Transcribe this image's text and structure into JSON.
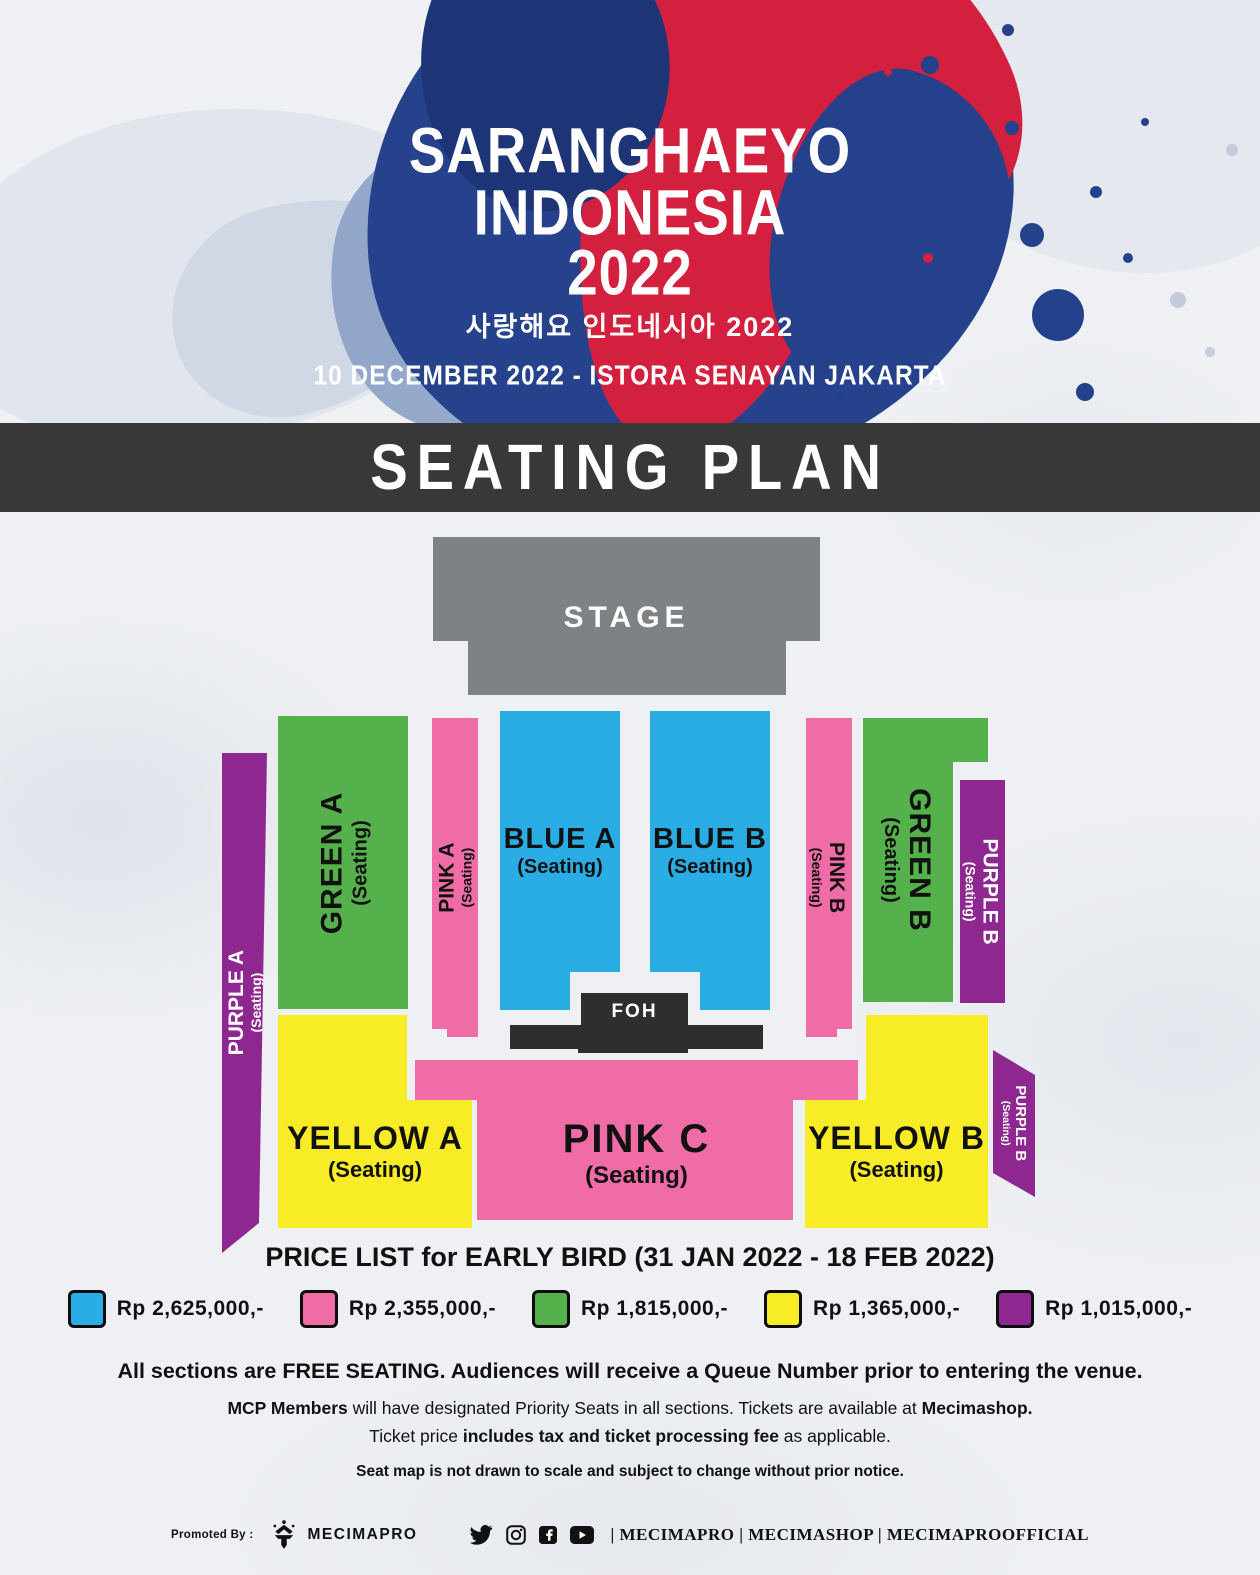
{
  "header": {
    "title_line1": "SARANGHAEYO",
    "title_line2": "INDONESIA",
    "title_line3": "2022",
    "subtitle_korean": "사랑해요 인도네시아 2022",
    "date_venue": "10 DECEMBER 2022 - ISTORA SENAYAN JAKARTA"
  },
  "banner": {
    "title": "SEATING PLAN"
  },
  "seating_map": {
    "stage_label": "STAGE",
    "foh_label": "FOH",
    "seating_suffix": "(Seating)",
    "sections": {
      "purple_a": "PURPLE A",
      "green_a": "GREEN A",
      "pink_a": "PINK A",
      "blue_a": "BLUE A",
      "blue_b": "BLUE B",
      "pink_b": "PINK B",
      "green_b": "GREEN B",
      "purple_b_upper": "PURPLE B",
      "yellow_a": "YELLOW A",
      "pink_c": "PINK C",
      "yellow_b": "YELLOW B",
      "purple_b_lower": "PURPLE B"
    }
  },
  "colors": {
    "blue": "#29ade4",
    "pink": "#f06ca6",
    "green": "#55b14c",
    "yellow": "#f8ec26",
    "purple": "#8e2790",
    "stage_gray": "#7f8285",
    "banner_dark": "#383838",
    "foh_dark": "#2e2e2e"
  },
  "price_list": {
    "heading": "PRICE LIST for EARLY BIRD (31 JAN 2022 - 18 FEB 2022)",
    "items": [
      {
        "section_color": "#29ade4",
        "label": "Rp 2,625,000,-"
      },
      {
        "section_color": "#f06ca6",
        "label": "Rp 2,355,000,-"
      },
      {
        "section_color": "#55b14c",
        "label": "Rp 1,815,000,-"
      },
      {
        "section_color": "#f8ec26",
        "label": "Rp 1,365,000,-"
      },
      {
        "section_color": "#8e2790",
        "label": "Rp 1,015,000,-"
      }
    ]
  },
  "notes": {
    "line1": "All sections are FREE SEATING. Audiences will receive a Queue Number prior to entering the venue.",
    "line2_bold1": "MCP Members",
    "line2_mid": " will have designated Priority Seats in all sections.  Tickets are available at ",
    "line2_bold2": "Mecimashop.",
    "line3_pre": "Ticket price ",
    "line3_bold": "includes tax and ticket processing fee",
    "line3_post": " as applicable.",
    "line4": "Seat map is not drawn to scale and subject to change without prior notice."
  },
  "footer": {
    "promoted_by": "Promoted By :",
    "brand": "MECIMAPRO",
    "social_icons": [
      "twitter-icon",
      "instagram-icon",
      "facebook-icon",
      "youtube-icon"
    ],
    "handles": "| MECIMAPRO | MECIMASHOP | MECIMAPROOFFICIAL"
  }
}
